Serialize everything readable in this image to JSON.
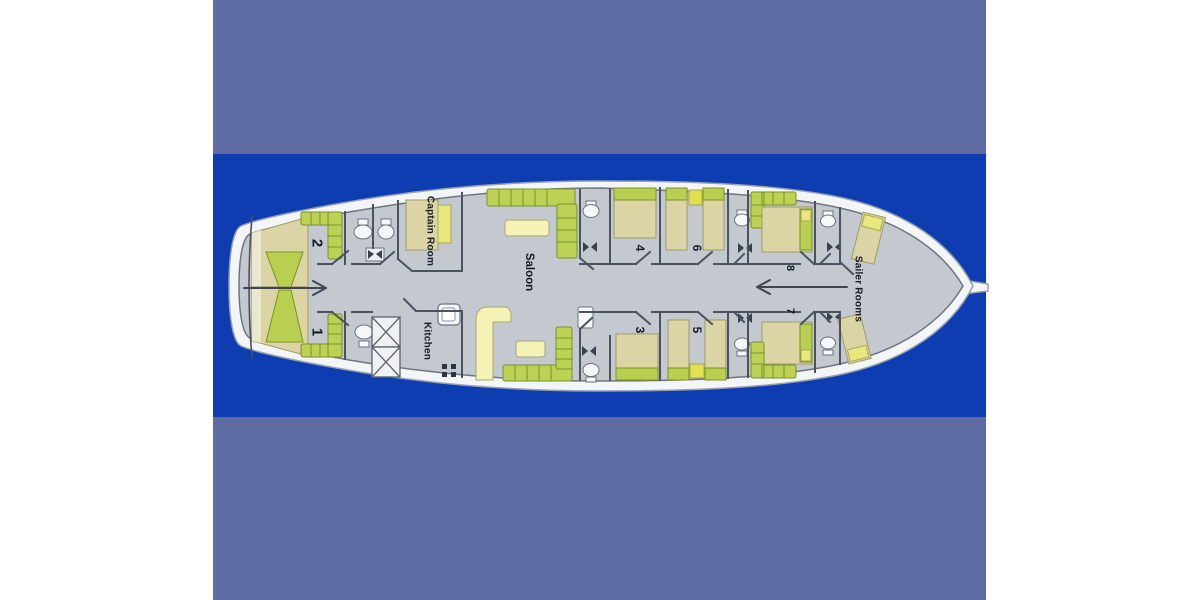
{
  "figure": {
    "type": "yacht-deck-floor-plan",
    "colors": {
      "margin": "#ffffff",
      "sea_outer": "#5e6ca3",
      "sea_band": "#0d3db0",
      "hull": "#f3f5f7",
      "deck": "#c4c8cf",
      "wall": "#4b5260",
      "sofa_green": "#bdd255",
      "bed_beige": "#dbd4a4",
      "table_yellow": "#f4f2b4",
      "pillow_yellow": "#e8e87c"
    },
    "labels": {
      "cabin1": "1",
      "cabin2": "2",
      "cabin3": "3",
      "cabin4": "4",
      "cabin5": "5",
      "cabin6": "6",
      "cabin7": "7",
      "cabin8": "8",
      "captain": "Captain Room",
      "kitchen": "Kitchen",
      "saloon": "Saloon",
      "sailer": "Sailer Rooms"
    }
  }
}
